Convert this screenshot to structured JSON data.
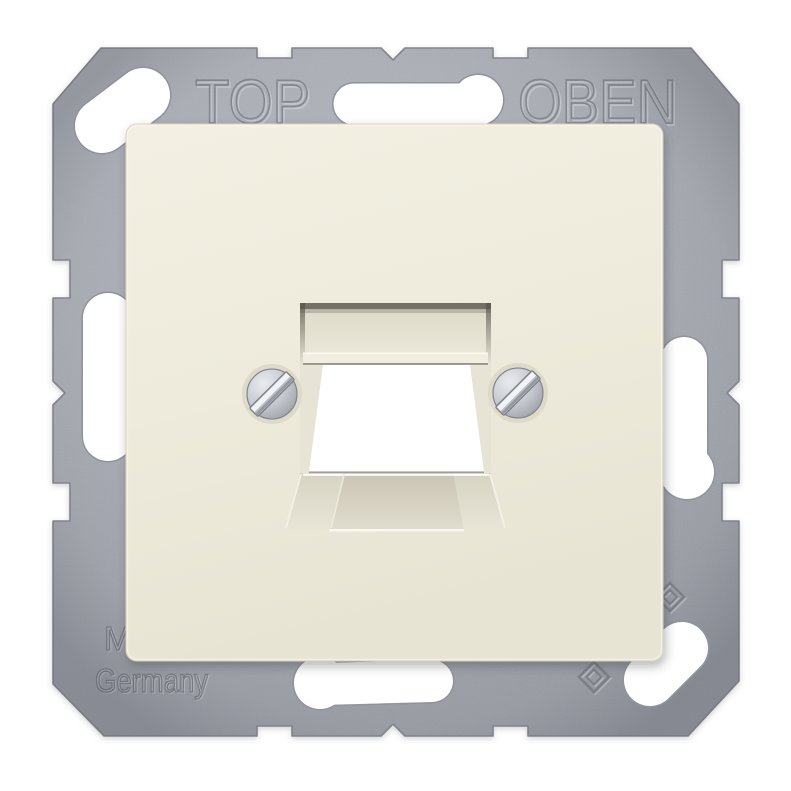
{
  "frame_markings": {
    "top_left": "TOP",
    "top_right": "OBEN",
    "bottom_line1_fragment": "M",
    "bottom_line2": "Germany"
  },
  "icons": {
    "insulation_class2_icon": "nested-diamond-emblem"
  },
  "colors": {
    "background": "#ffffff",
    "metal_frame": "#a8abb3",
    "metal_engraving": "#82858e",
    "cover_plate": "#efecdd",
    "screw_head": "#c2c5cb",
    "cutout_void": "#ffffff"
  }
}
